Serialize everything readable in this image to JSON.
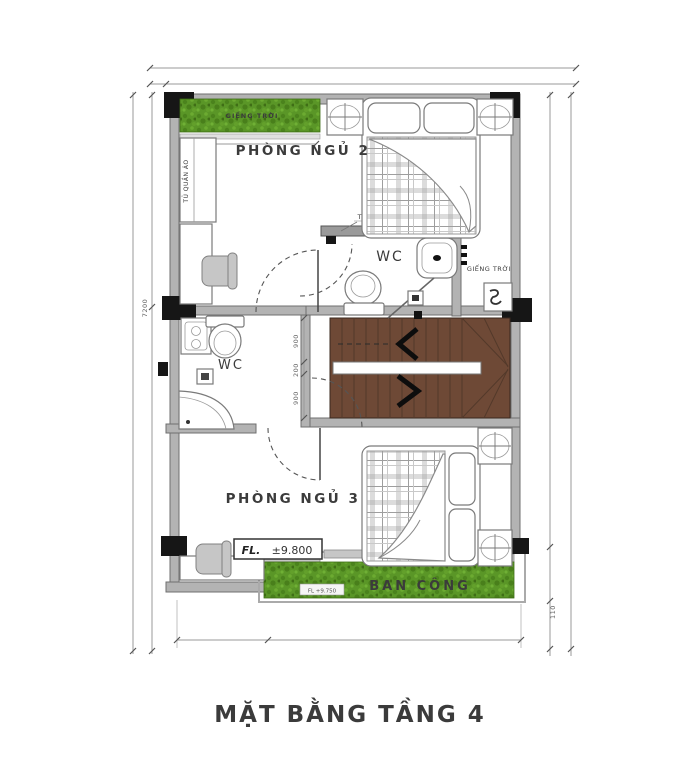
{
  "title": "MẶT BẰNG TẦNG 4",
  "rooms": {
    "bedroom2": "PHÒNG NGỦ 2",
    "bedroom3": "PHÒNG NGỦ 3",
    "wc_main": "WC",
    "wc_small": "WC",
    "balcony": "BAN CÔNG"
  },
  "annotations": {
    "skylight_strip": "GIẾNG TRỜI",
    "skylight_side": "GIẾNG TRỜI",
    "wardrobe": "TỦ QUẦN ÁO",
    "tv_wall": "TIVI TREO TƯỜNG",
    "floor_level_prefix": "FL.",
    "floor_level_value": "±9.800",
    "balcony_level": "FL +9.750"
  },
  "dimensions": {
    "stair_run_top": "900",
    "stair_landing": "200",
    "stair_run_bottom": "900",
    "left_overall": "7200",
    "right_side": "110"
  },
  "colors": {
    "grass": "#5a9627",
    "stair_wood": "#6e4936",
    "wall": "#b3b3b3",
    "column": "#161616",
    "text": "#3b3b3b"
  }
}
